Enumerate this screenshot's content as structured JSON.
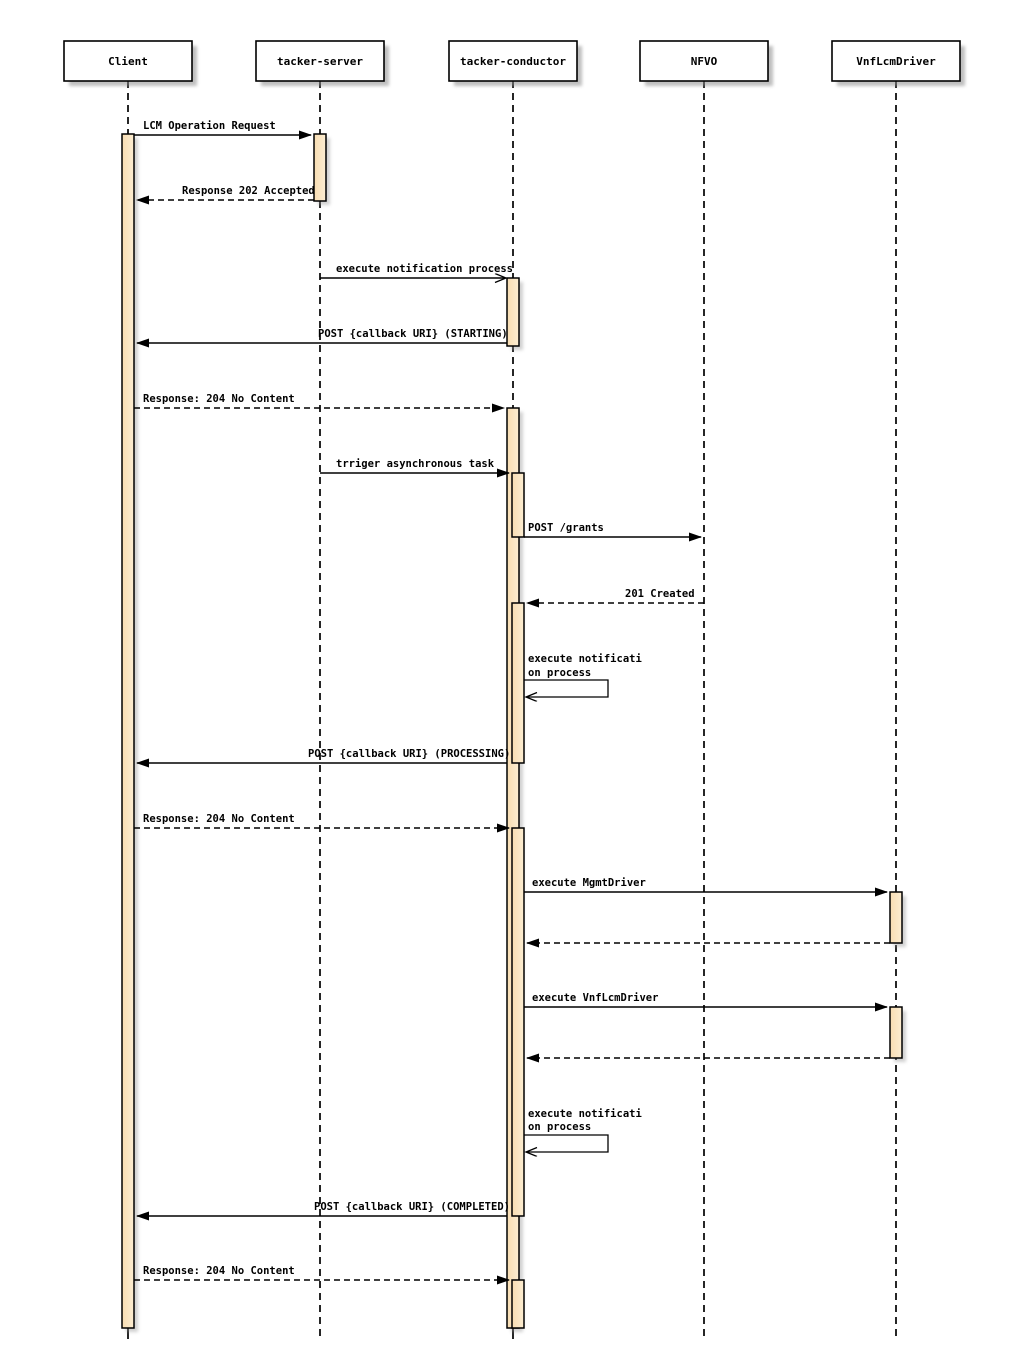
{
  "diagram": {
    "type": "sequence",
    "participants": [
      {
        "name": "Client"
      },
      {
        "name": "tacker-server"
      },
      {
        "name": "tacker-conductor"
      },
      {
        "name": "NFVO"
      },
      {
        "name": "VnfLcmDriver"
      }
    ],
    "messages": [
      {
        "from": "Client",
        "to": "tacker-server",
        "label": "LCM Operation Request",
        "style": "solid"
      },
      {
        "from": "tacker-server",
        "to": "Client",
        "label": "Response 202 Accepted",
        "style": "dashed"
      },
      {
        "from": "tacker-server",
        "to": "tacker-conductor",
        "label": "execute notification process",
        "style": "solid-open"
      },
      {
        "from": "tacker-conductor",
        "to": "Client",
        "label": "POST {callback URI} (STARTING)",
        "style": "solid"
      },
      {
        "from": "Client",
        "to": "tacker-conductor",
        "label": "Response: 204 No Content",
        "style": "dashed"
      },
      {
        "from": "tacker-server",
        "to": "tacker-conductor",
        "label": "trriger asynchronous task",
        "style": "solid"
      },
      {
        "from": "tacker-conductor",
        "to": "NFVO",
        "label": "POST /grants",
        "style": "solid"
      },
      {
        "from": "NFVO",
        "to": "tacker-conductor",
        "label": "201 Created",
        "style": "dashed"
      },
      {
        "from": "tacker-conductor",
        "to": "tacker-conductor",
        "label_lines": [
          "execute notificati",
          "on process"
        ],
        "style": "self"
      },
      {
        "from": "tacker-conductor",
        "to": "Client",
        "label": "POST {callback URI} (PROCESSING)",
        "style": "solid"
      },
      {
        "from": "Client",
        "to": "tacker-conductor",
        "label": "Response: 204 No Content",
        "style": "dashed"
      },
      {
        "from": "tacker-conductor",
        "to": "VnfLcmDriver",
        "label": "execute MgmtDriver",
        "style": "solid"
      },
      {
        "from": "VnfLcmDriver",
        "to": "tacker-conductor",
        "label": "",
        "style": "dashed"
      },
      {
        "from": "tacker-conductor",
        "to": "VnfLcmDriver",
        "label": "execute VnfLcmDriver",
        "style": "solid"
      },
      {
        "from": "VnfLcmDriver",
        "to": "tacker-conductor",
        "label": "",
        "style": "dashed"
      },
      {
        "from": "tacker-conductor",
        "to": "tacker-conductor",
        "label_lines": [
          "execute notificati",
          "on process"
        ],
        "style": "self"
      },
      {
        "from": "tacker-conductor",
        "to": "Client",
        "label": "POST {callback URI} (COMPLETED)",
        "style": "solid"
      },
      {
        "from": "Client",
        "to": "tacker-conductor",
        "label": "Response: 204 No Content",
        "style": "dashed"
      }
    ],
    "colors": {
      "background": "#ffffff",
      "line": "#000000",
      "activation_fill_left": "#F8DDB2",
      "activation_fill_right": "#FCEDD2",
      "shadow": "#8a8a8a"
    }
  }
}
